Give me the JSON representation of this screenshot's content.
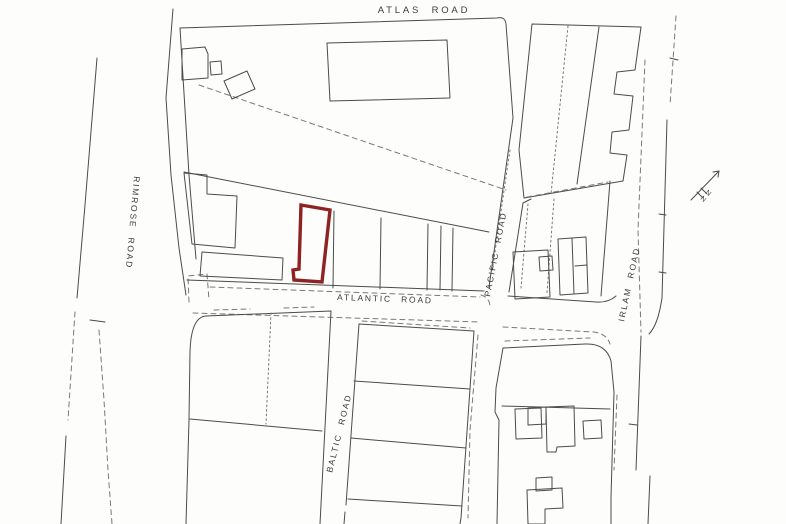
{
  "page": {
    "colors": {
      "ink": "#4b4b47",
      "ink-light": "#7a7973",
      "highlight": "#8e2323",
      "paper": "#fdfdfc",
      "label": "#3c3c38"
    }
  },
  "map": {
    "type": "site-location-plan",
    "roads": {
      "atlas": {
        "label": "ATLAS ROAD"
      },
      "rimrose": {
        "label": "RIMROSE ROAD"
      },
      "atlantic": {
        "label": "ATLANTIC ROAD"
      },
      "pacific": {
        "label": "PACIFIC ROAD"
      },
      "baltic": {
        "label": "BALTIC ROAD"
      },
      "irlam": {
        "label": "IRLAM ROAD"
      }
    },
    "compass": {
      "label": "N"
    },
    "highlighted_plot": {
      "outline_color": "#8e2323"
    }
  }
}
